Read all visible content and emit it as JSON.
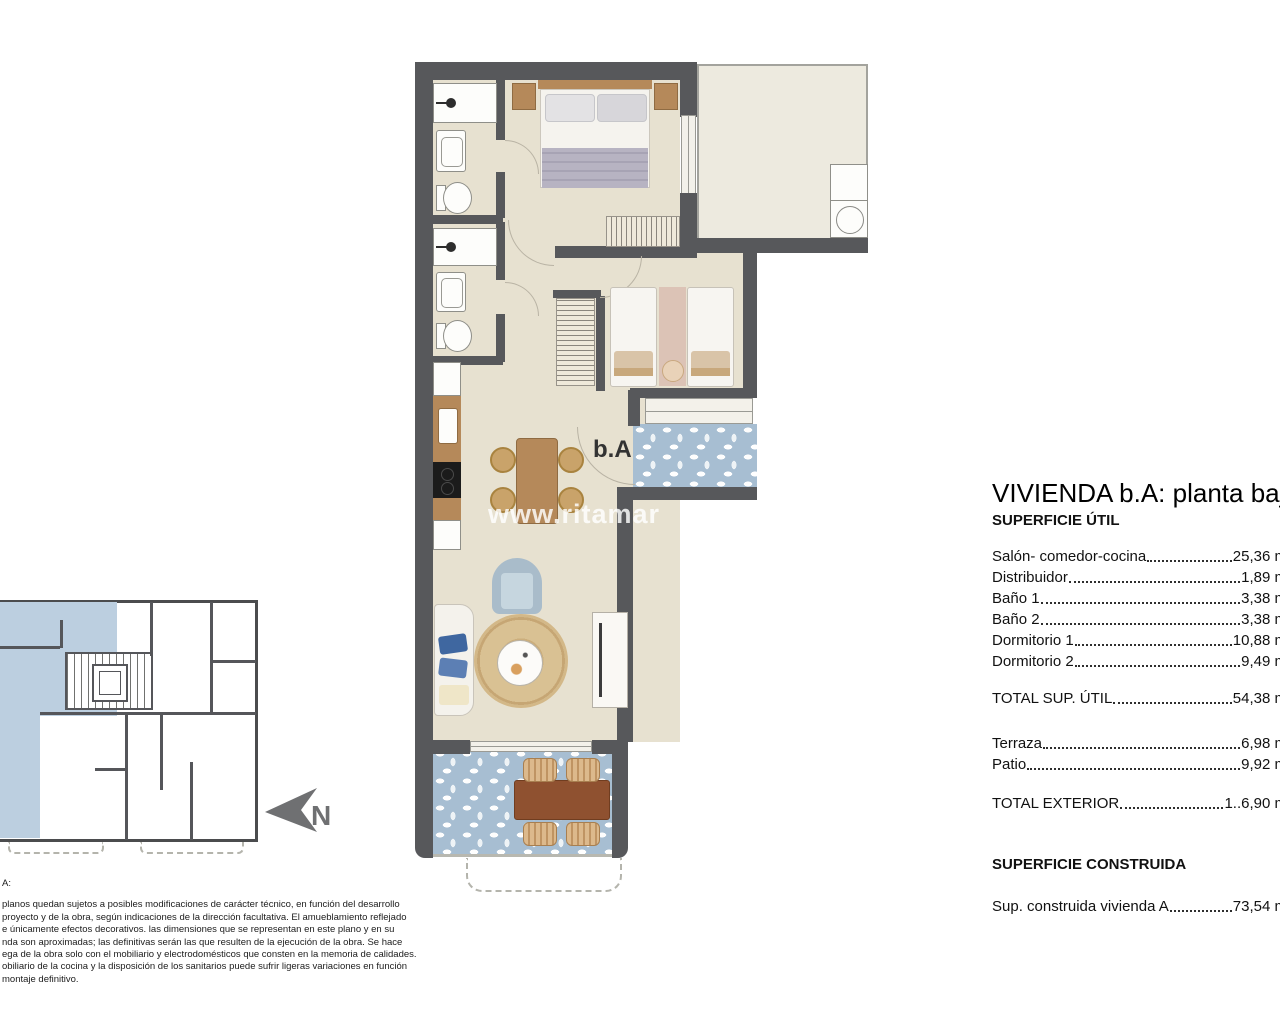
{
  "panel": {
    "title": "VIVIENDA b.A: planta baja",
    "util_header": "SUPERFICIE ÚTIL",
    "rows": [
      {
        "label": "Salón- comedor-cocina",
        "value": "25,36 m²"
      },
      {
        "label": "Distribuidor",
        "value": "1,89 m²"
      },
      {
        "label": "Baño 1",
        "value": "3,38 m²"
      },
      {
        "label": "Baño 2",
        "value": "3,38 m²"
      },
      {
        "label": "Dormitorio 1",
        "value": "10,88 m²"
      },
      {
        "label": "Dormitorio 2",
        "value": "9,49 m²"
      }
    ],
    "total_util": {
      "label": "TOTAL SUP. ÚTIL",
      "value": "54,38 m²"
    },
    "exterior_rows": [
      {
        "label": "Terraza",
        "value": "6,98 m²"
      },
      {
        "label": "Patio",
        "value": "9,92 m²"
      }
    ],
    "total_exterior": {
      "label": "TOTAL EXTERIOR",
      "value": "1..6,90 m²"
    },
    "constructed_header": "SUPERFICIE CONSTRUIDA",
    "constructed_row": {
      "label": "Sup. construida vivienda A",
      "value": "73,54 m²"
    }
  },
  "plan": {
    "unit_label": "b.A",
    "watermark": "www.ritamar"
  },
  "key_plan": {
    "north_label": "N"
  },
  "disclaimer": {
    "lines": [
      "A:",
      "planos quedan sujetos a posibles modificaciones de carácter técnico, en función del desarrollo",
      "proyecto y de la obra, según indicaciones de la dirección facultativa. El amueblamiento reflejado",
      "e únicamente efectos decorativos. las dimensiones que se representan en este plano y en su",
      "nda son aproximadas; las definitivas serán las que resulten de la ejecución de la obra. Se hace",
      "ega de la obra solo con el mobiliario y electrodomésticos que consten en la memoria de calidades.",
      "obiliario de la cocina y la disposición de los sanitarios puede sufrir ligeras variaciones en función",
      "montaje definitivo."
    ]
  },
  "colors": {
    "wall": "#57585b",
    "interior_floor": "#e7e1d0",
    "patio_floor": "#edeadf",
    "tile_blue": "#a7bed2",
    "keyplan_highlight": "#bccfe0",
    "wood": "#b5895a",
    "terrace_table_wood": "#8f5130"
  }
}
